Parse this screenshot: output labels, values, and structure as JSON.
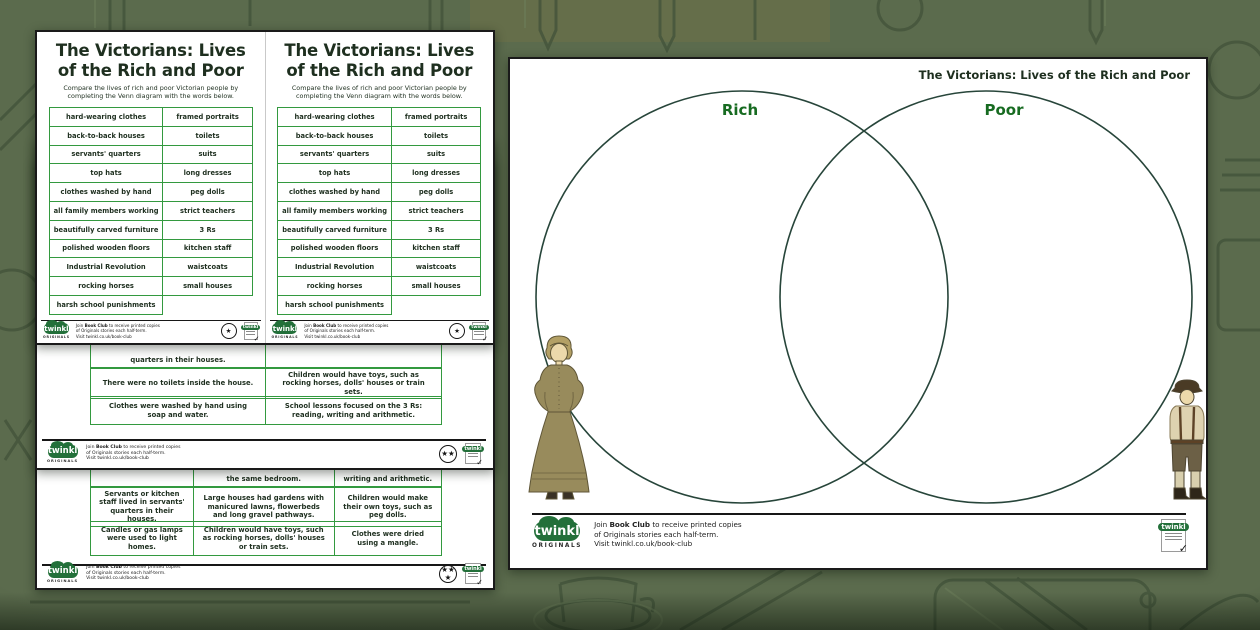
{
  "colors": {
    "background_olive": "#5b6b4d",
    "table_border_green": "#33993f",
    "ink": "#1e2f1f",
    "venn_label_green": "#176b21",
    "twinkl_green": "#23703a"
  },
  "worksheet": {
    "title": "The Victorians: Lives of the Rich and Poor",
    "subtitle": "Compare the lives of rich and poor Victorian people by completing the Venn diagram with the words below.",
    "word_bank": [
      [
        "hard-wearing clothes",
        "framed portraits"
      ],
      [
        "back-to-back houses",
        "toilets"
      ],
      [
        "servants' quarters",
        "suits"
      ],
      [
        "top hats",
        "long dresses"
      ],
      [
        "clothes washed by hand",
        "peg dolls"
      ],
      [
        "all family members working",
        "strict teachers"
      ],
      [
        "beautifully carved furniture",
        "3 Rs"
      ],
      [
        "polished wooden floors",
        "kitchen staff"
      ],
      [
        "Industrial Revolution",
        "waistcoats"
      ],
      [
        "rocking horses",
        "small houses"
      ],
      [
        "harsh school punishments",
        ""
      ]
    ]
  },
  "venn": {
    "page_title": "The Victorians: Lives of the Rich and Poor",
    "left_label": "Rich",
    "right_label": "Poor"
  },
  "facts_two_star": {
    "clipped_row": [
      "quarters in their houses.",
      ""
    ],
    "rows": [
      [
        "There were no toilets inside the house.",
        "Children would have toys, such as rocking horses, dolls' houses or train sets."
      ],
      [
        "Clothes were washed by hand using soap and water.",
        "School lessons focused on the 3 Rs: reading, writing and arithmetic."
      ]
    ]
  },
  "facts_three_star": {
    "clipped_row": [
      "",
      "the same bedroom.",
      "writing and arithmetic."
    ],
    "rows": [
      [
        "Servants or kitchen staff lived in servants' quarters in their houses.",
        "Large houses had gardens with manicured lawns, flowerbeds and long gravel pathways.",
        "Children would make their own toys, such as peg dolls."
      ],
      [
        "Candles or gas lamps were used to light homes.",
        "Children would have toys, such as rocking horses, dolls' houses or train sets.",
        "Clothes were dried using a mangle."
      ]
    ]
  },
  "branding": {
    "logo_text": "twinkl",
    "originals_text": "ORIGINALS",
    "book_club_line1_pre": "Join ",
    "book_club_line1_bold": "Book Club",
    "book_club_line1_post": " to receive printed copies",
    "book_club_line2": "of Originals stories each half-term.",
    "book_club_line3": "Visit twinkl.co.uk/book-club",
    "difficulty_one_star": "★",
    "difficulty_two_star": "★★",
    "difficulty_three_star": "★★★"
  }
}
